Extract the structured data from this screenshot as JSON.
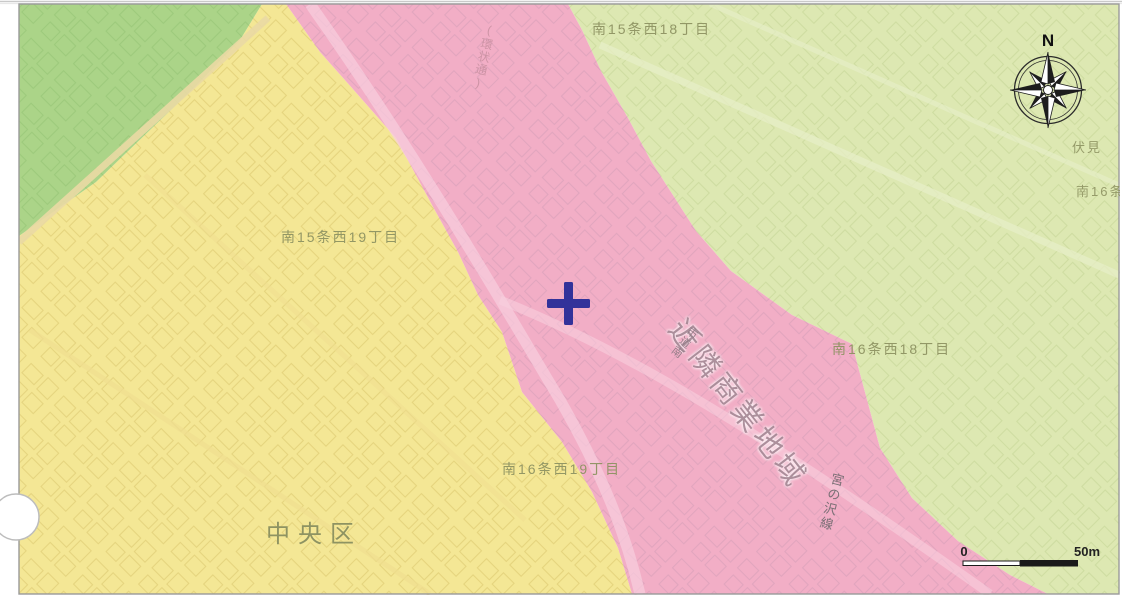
{
  "colors": {
    "yellow_zone": "#f4e795",
    "pink_zone": "#f2aec6",
    "light_green_zone": "#dde8b2",
    "green_zone": "#abd488",
    "marker": "#32329a"
  },
  "map": {
    "district_labels": {
      "top": "南15条西18丁目",
      "west": "南15条西19丁目",
      "east": "南16条西18丁目",
      "south": "南16条西19丁目"
    },
    "ward_label": "中央区",
    "zone_label": "近隣商業地域",
    "road_labels": {
      "city_road_prefix": "市道南",
      "miyanosawa_line": "宮の沢線",
      "kanjo_dori": "(環状通)"
    },
    "edge_labels": {
      "fushimi": "伏見",
      "minami16": "南16条"
    },
    "compass": {
      "north": "N"
    },
    "scale_bar": {
      "zero": "0",
      "fifty": "50m"
    }
  }
}
